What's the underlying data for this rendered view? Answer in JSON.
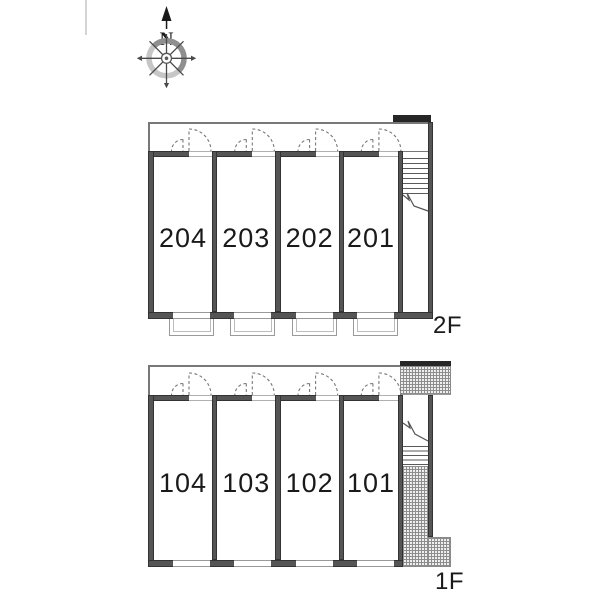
{
  "compass": {
    "north_label": "N"
  },
  "floors": [
    {
      "label": "2F",
      "rooms": [
        {
          "number": "204"
        },
        {
          "number": "203"
        },
        {
          "number": "202"
        },
        {
          "number": "201"
        }
      ]
    },
    {
      "label": "1F",
      "rooms": [
        {
          "number": "104"
        },
        {
          "number": "103"
        },
        {
          "number": "102"
        },
        {
          "number": "101"
        }
      ]
    }
  ],
  "colors": {
    "wall": "#555555",
    "wall_edge": "#333333",
    "entrance_bar": "#262626",
    "hatch_line": "#8d8d8d",
    "thin_line": "#999999",
    "text": "#1a1a1a"
  }
}
